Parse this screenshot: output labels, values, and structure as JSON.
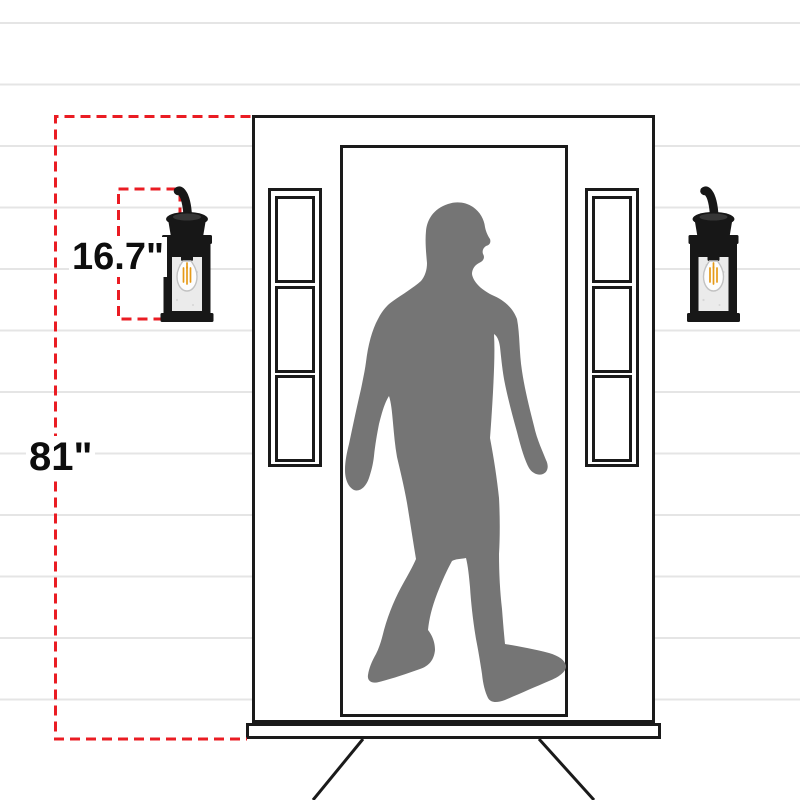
{
  "dimensions": {
    "fixture_height": "16.7\"",
    "mounting_height": "81\""
  },
  "figures": {
    "left_fixture": "wall-lantern",
    "right_fixture": "wall-lantern",
    "center": "walking-man-silhouette",
    "setting": "front-door-with-sidelights-on-shiplap-wall"
  },
  "colors": {
    "dimension_red": "#ea1c23",
    "silhouette_gray": "#757575",
    "outline_black": "#1a1a1a",
    "fixture_black": "#171717",
    "siding_line_gray": "#e5e5e5",
    "glass_gray": "#ebebeb",
    "filament_orange": "#e59a17",
    "background_white": "#ffffff"
  }
}
